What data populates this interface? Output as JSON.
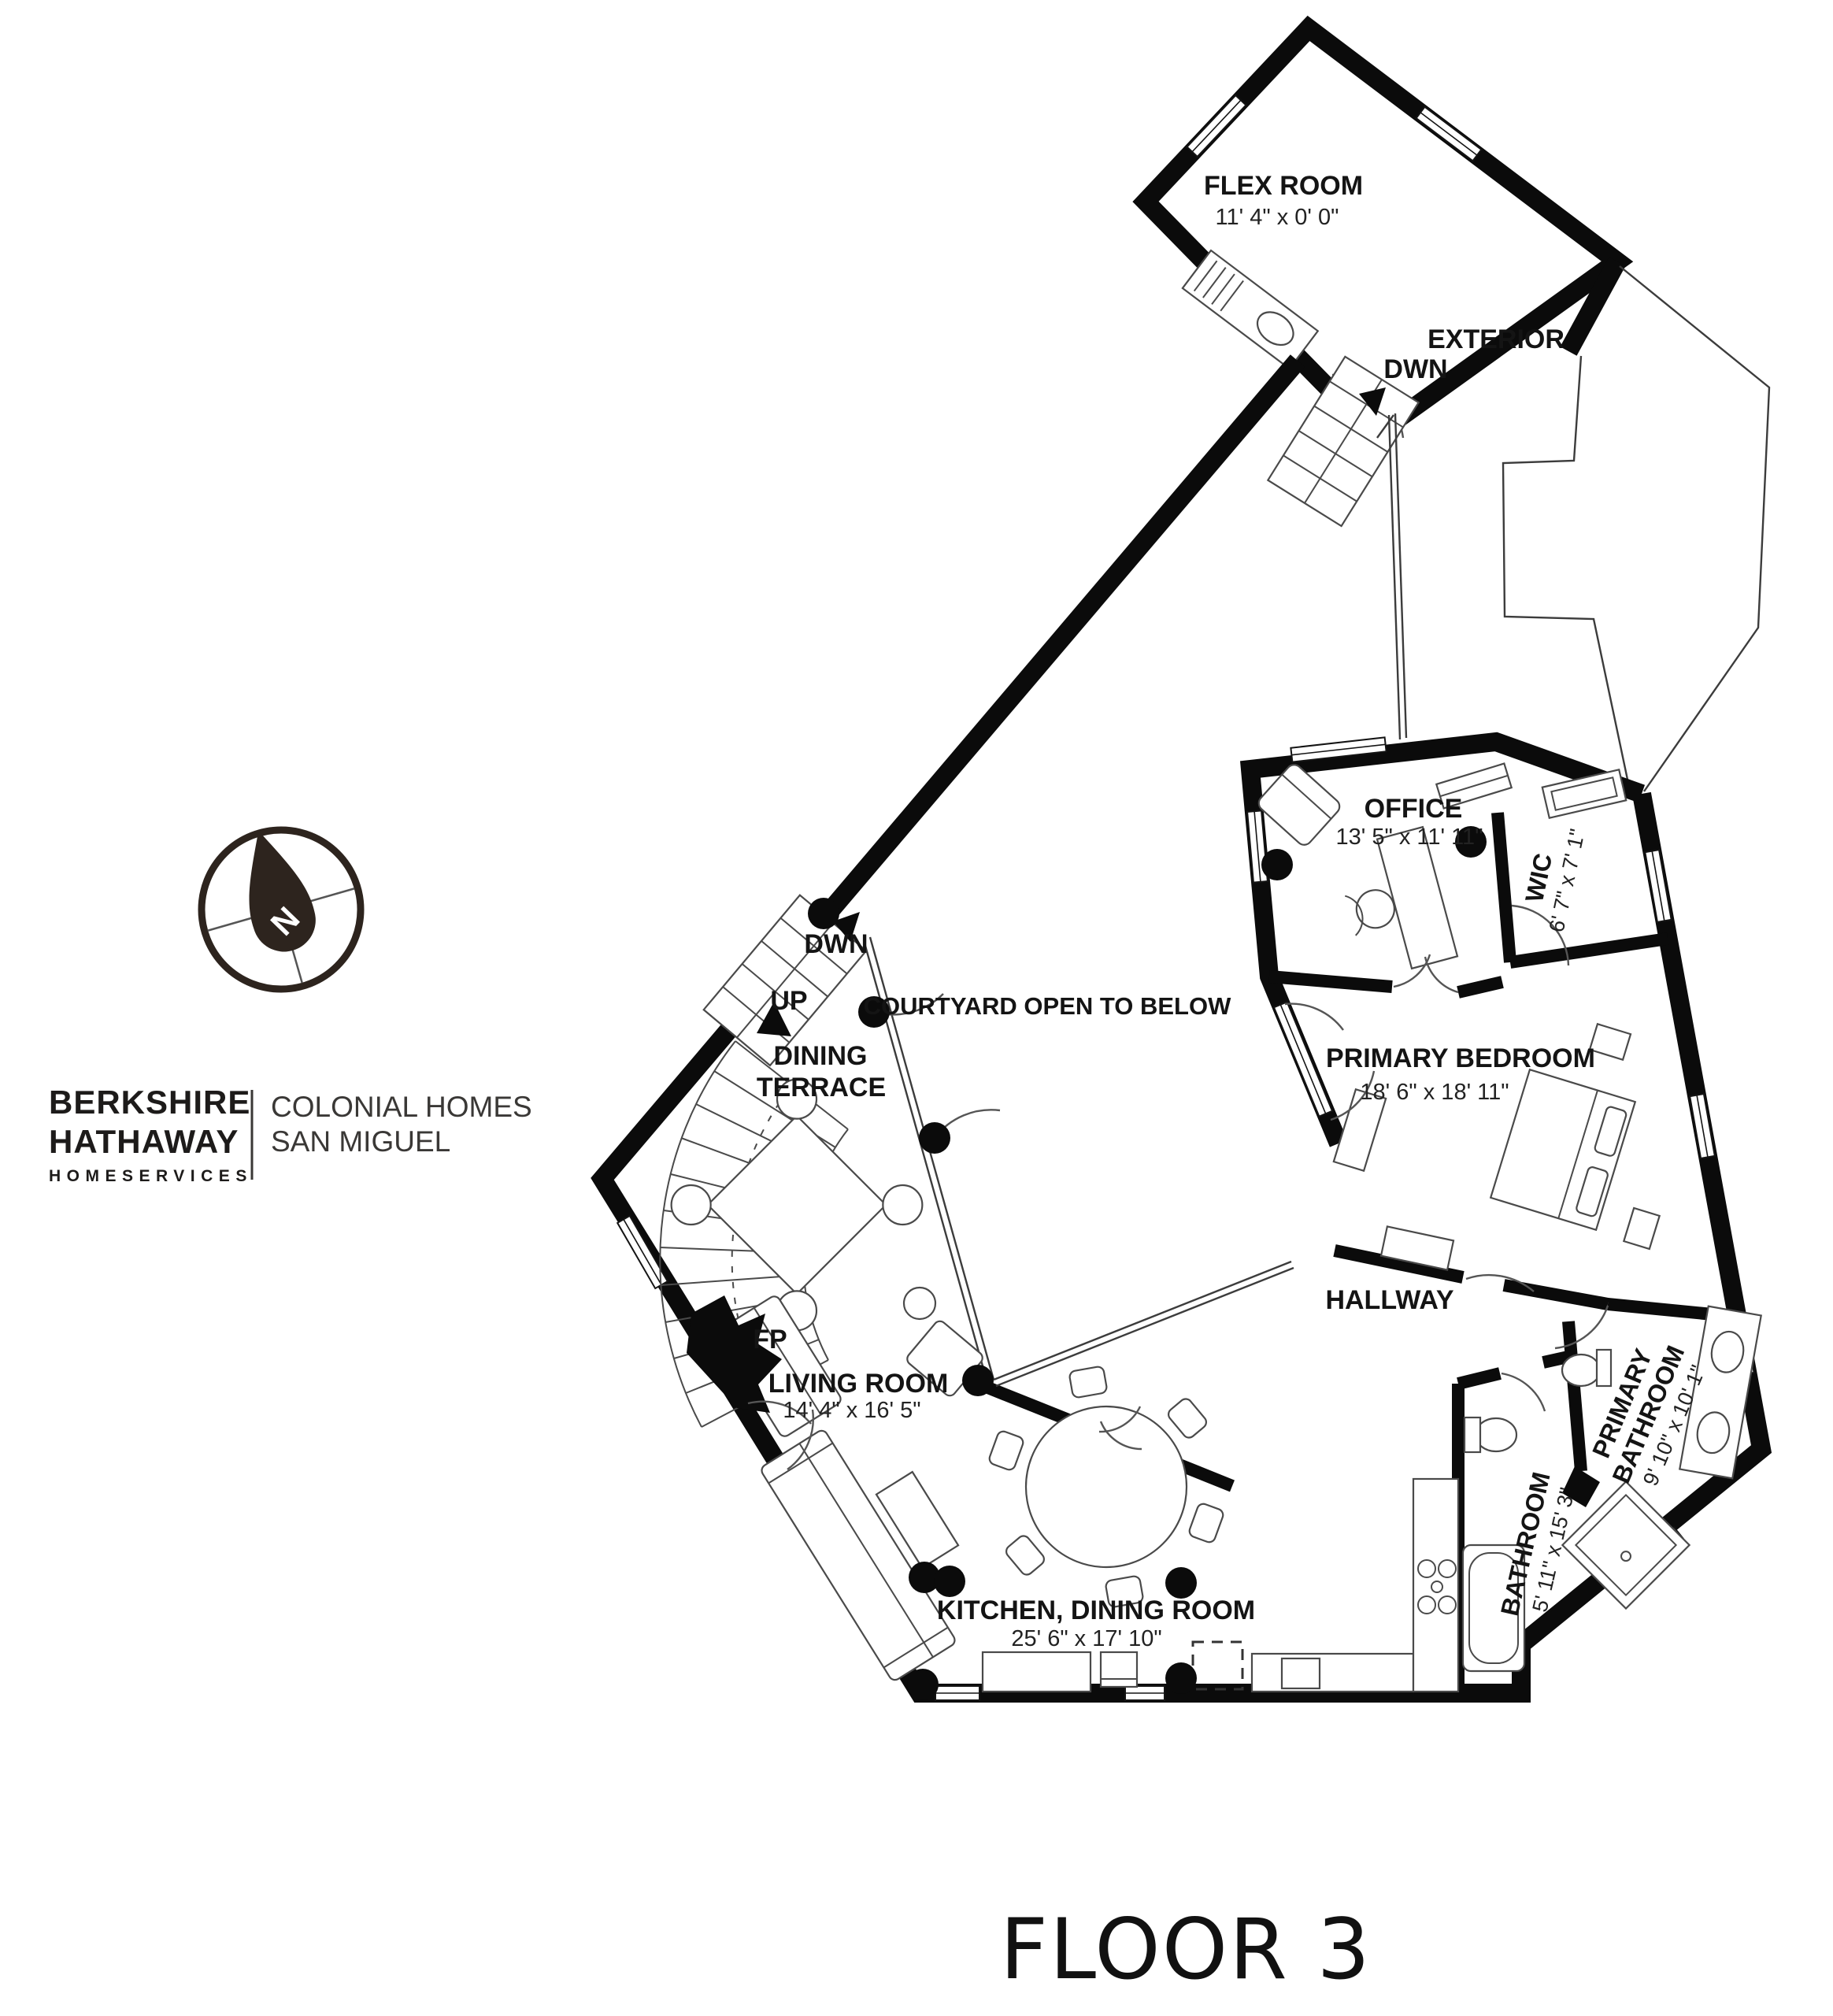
{
  "title": "FLOOR 3",
  "brand": {
    "line1": "BERKSHIRE",
    "line2": "HATHAWAY",
    "line3": "HOMESERVICES",
    "agency_line1": "COLONIAL HOMES",
    "agency_line2": "SAN MIGUEL"
  },
  "compass": {
    "north": "N"
  },
  "labels": {
    "exterior": "EXTERIOR",
    "courtyard": "COURTYARD OPEN TO BELOW",
    "fireplace": "FP",
    "stairs_down": "DWN",
    "stairs_up": "UP"
  },
  "rooms": {
    "flex_room": {
      "name": "FLEX ROOM",
      "dims": "11' 4\" x 0' 0\""
    },
    "office": {
      "name": "OFFICE",
      "dims": "13' 5\" x 11' 11\""
    },
    "wic": {
      "name": "WIC",
      "dims": "6' 7\" x 7' 1\""
    },
    "dining_terrace": {
      "line1": "DINING",
      "line2": "TERRACE"
    },
    "primary_bedroom": {
      "name": "PRIMARY BEDROOM",
      "dims": "18' 6\" x 18' 11\""
    },
    "hallway": {
      "name": "HALLWAY"
    },
    "living_room": {
      "name": "LIVING ROOM",
      "dims": "14' 4\" x 16' 5\""
    },
    "kitchen_dining_room": {
      "name": "KITCHEN, DINING ROOM",
      "dims": "25' 6\" x 17' 10\""
    },
    "bathroom": {
      "name": "BATHROOM",
      "dims": "5' 11\" x 15' 3\""
    },
    "primary_bathroom": {
      "line1": "PRIMARY",
      "line2": "BATHROOM",
      "dims": "9' 10\" x 10' 1\""
    }
  }
}
